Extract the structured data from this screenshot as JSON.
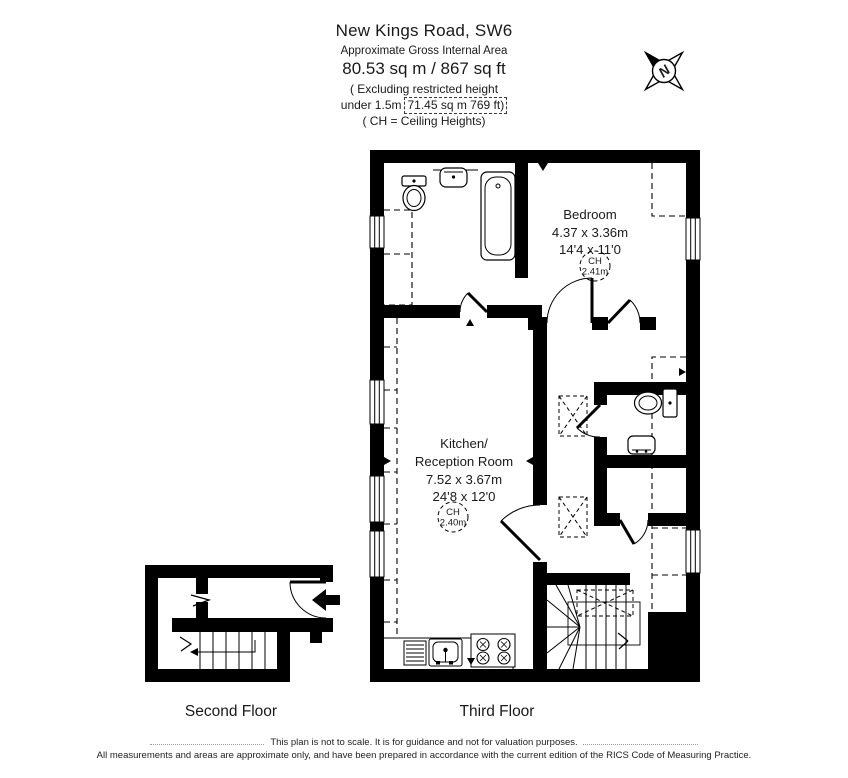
{
  "header": {
    "title": "New Kings Road, SW6",
    "subtitle": "Approximate Gross Internal Area",
    "area": "80.53 sq m / 867 sq ft",
    "note_line1": "( Excluding restricted height",
    "note_line2_prefix": "under 1.5m",
    "note_line2_boxed": "71.45 sq m 769 ft)",
    "note_line3": "( CH = Ceiling Heights)"
  },
  "compass": {
    "label": "N"
  },
  "plan": {
    "rooms": {
      "bedroom": {
        "name": "Bedroom",
        "dimensions_metric": "4.37 x 3.36m",
        "dimensions_imperial": "14'4 x 11'0",
        "ch_label": "CH",
        "ch_value": "2.41m"
      },
      "kitchen_reception": {
        "name_line1": "Kitchen/",
        "name_line2": "Reception Room",
        "dimensions_metric": "7.52 x 3.67m",
        "dimensions_imperial": "24'8 x 12'0",
        "ch_label": "CH",
        "ch_value": "2.40m"
      }
    },
    "floor_labels": {
      "second": "Second Floor",
      "third": "Third Floor"
    }
  },
  "disclaimer": {
    "line1": "This plan is not to scale. It is for guidance and not for valuation purposes.",
    "line2": "All measurements and areas are approximate only, and have been prepared in accordance with the current edition of the RICS Code of Measuring Practice."
  },
  "colors": {
    "wall": "#000000",
    "background": "#ffffff"
  }
}
